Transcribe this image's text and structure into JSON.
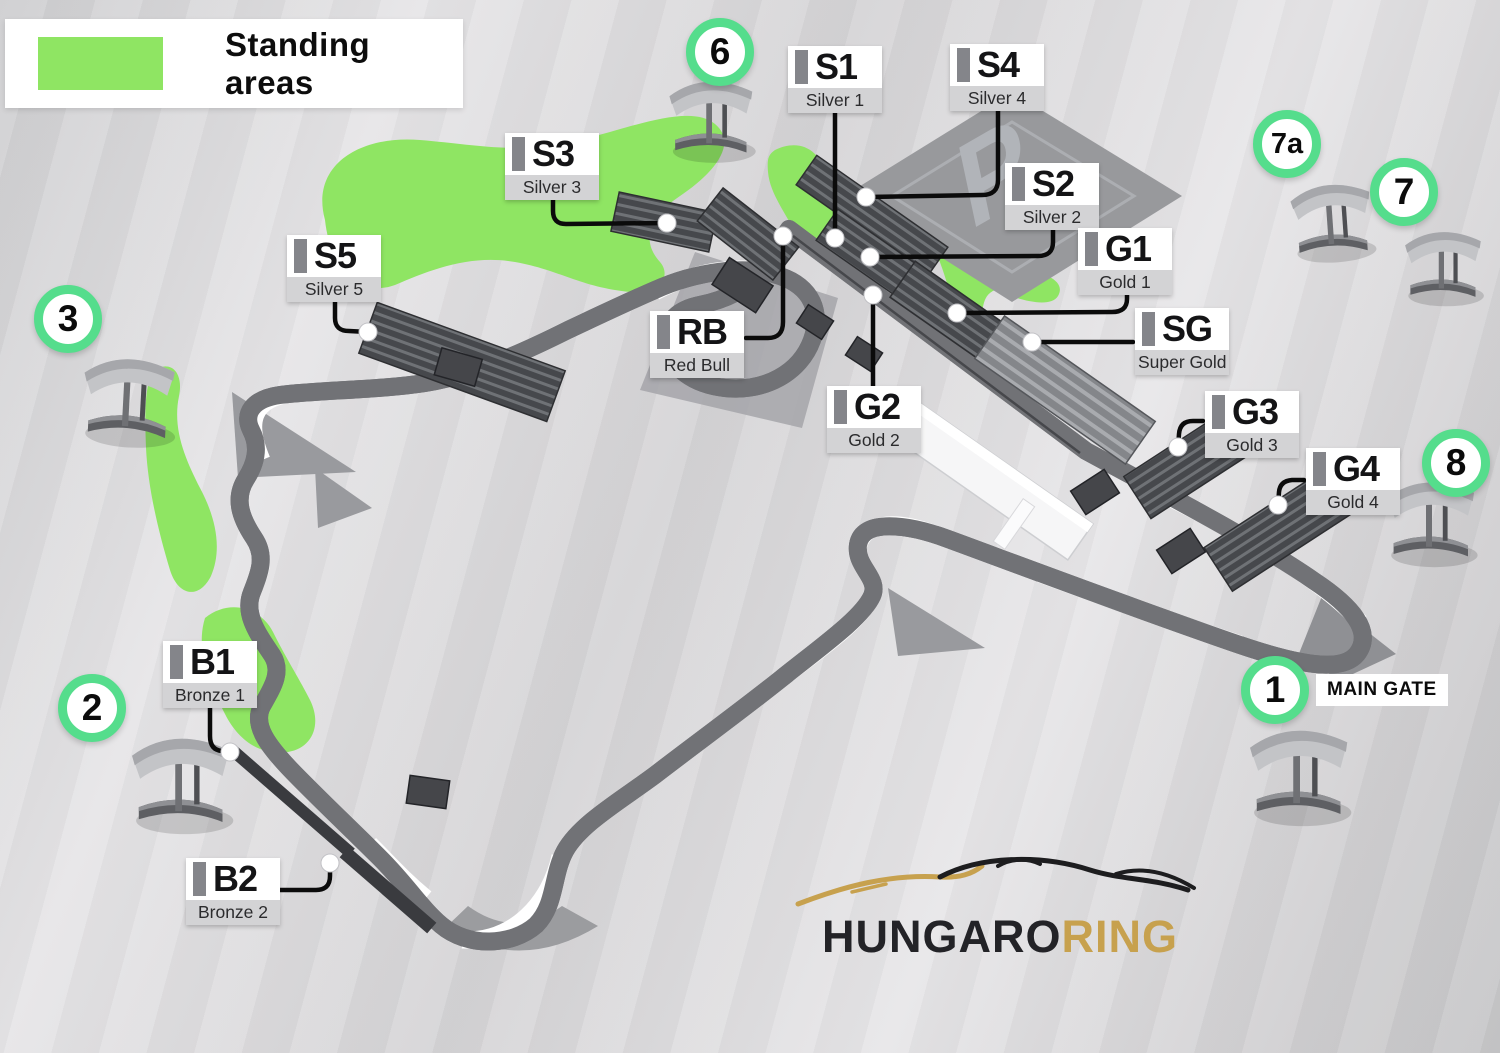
{
  "legend": {
    "label": "Standing areas",
    "swatch_color": "#8fe563"
  },
  "stands": [
    {
      "id": "s1",
      "code": "S1",
      "name": "Silver 1"
    },
    {
      "id": "s2",
      "code": "S2",
      "name": "Silver 2"
    },
    {
      "id": "s3",
      "code": "S3",
      "name": "Silver 3"
    },
    {
      "id": "s4",
      "code": "S4",
      "name": "Silver 4"
    },
    {
      "id": "s5",
      "code": "S5",
      "name": "Silver 5"
    },
    {
      "id": "sg",
      "code": "SG",
      "name": "Super Gold"
    },
    {
      "id": "g1",
      "code": "G1",
      "name": "Gold 1"
    },
    {
      "id": "g2",
      "code": "G2",
      "name": "Gold 2"
    },
    {
      "id": "g3",
      "code": "G3",
      "name": "Gold 3"
    },
    {
      "id": "g4",
      "code": "G4",
      "name": "Gold 4"
    },
    {
      "id": "rb",
      "code": "RB",
      "name": "Red Bull"
    },
    {
      "id": "b1",
      "code": "B1",
      "name": "Bronze 1"
    },
    {
      "id": "b2",
      "code": "B2",
      "name": "Bronze 2"
    }
  ],
  "gates": [
    {
      "id": "1",
      "number": "1",
      "label": "MAIN GATE"
    },
    {
      "id": "2",
      "number": "2"
    },
    {
      "id": "3",
      "number": "3"
    },
    {
      "id": "6",
      "number": "6"
    },
    {
      "id": "7a",
      "number": "7a"
    },
    {
      "id": "7",
      "number": "7"
    },
    {
      "id": "8",
      "number": "8"
    }
  ],
  "parking": {
    "symbol": "P"
  },
  "logo": {
    "part1": "HUNGARO",
    "part2": "RING"
  },
  "colors": {
    "standing_area_green": "#8fe563",
    "gate_ring_green": "#55dd8c",
    "logo_gold": "#c7a14e",
    "track_surface": "#f2f2f3",
    "grandstand_dark": "#4a4c50"
  }
}
